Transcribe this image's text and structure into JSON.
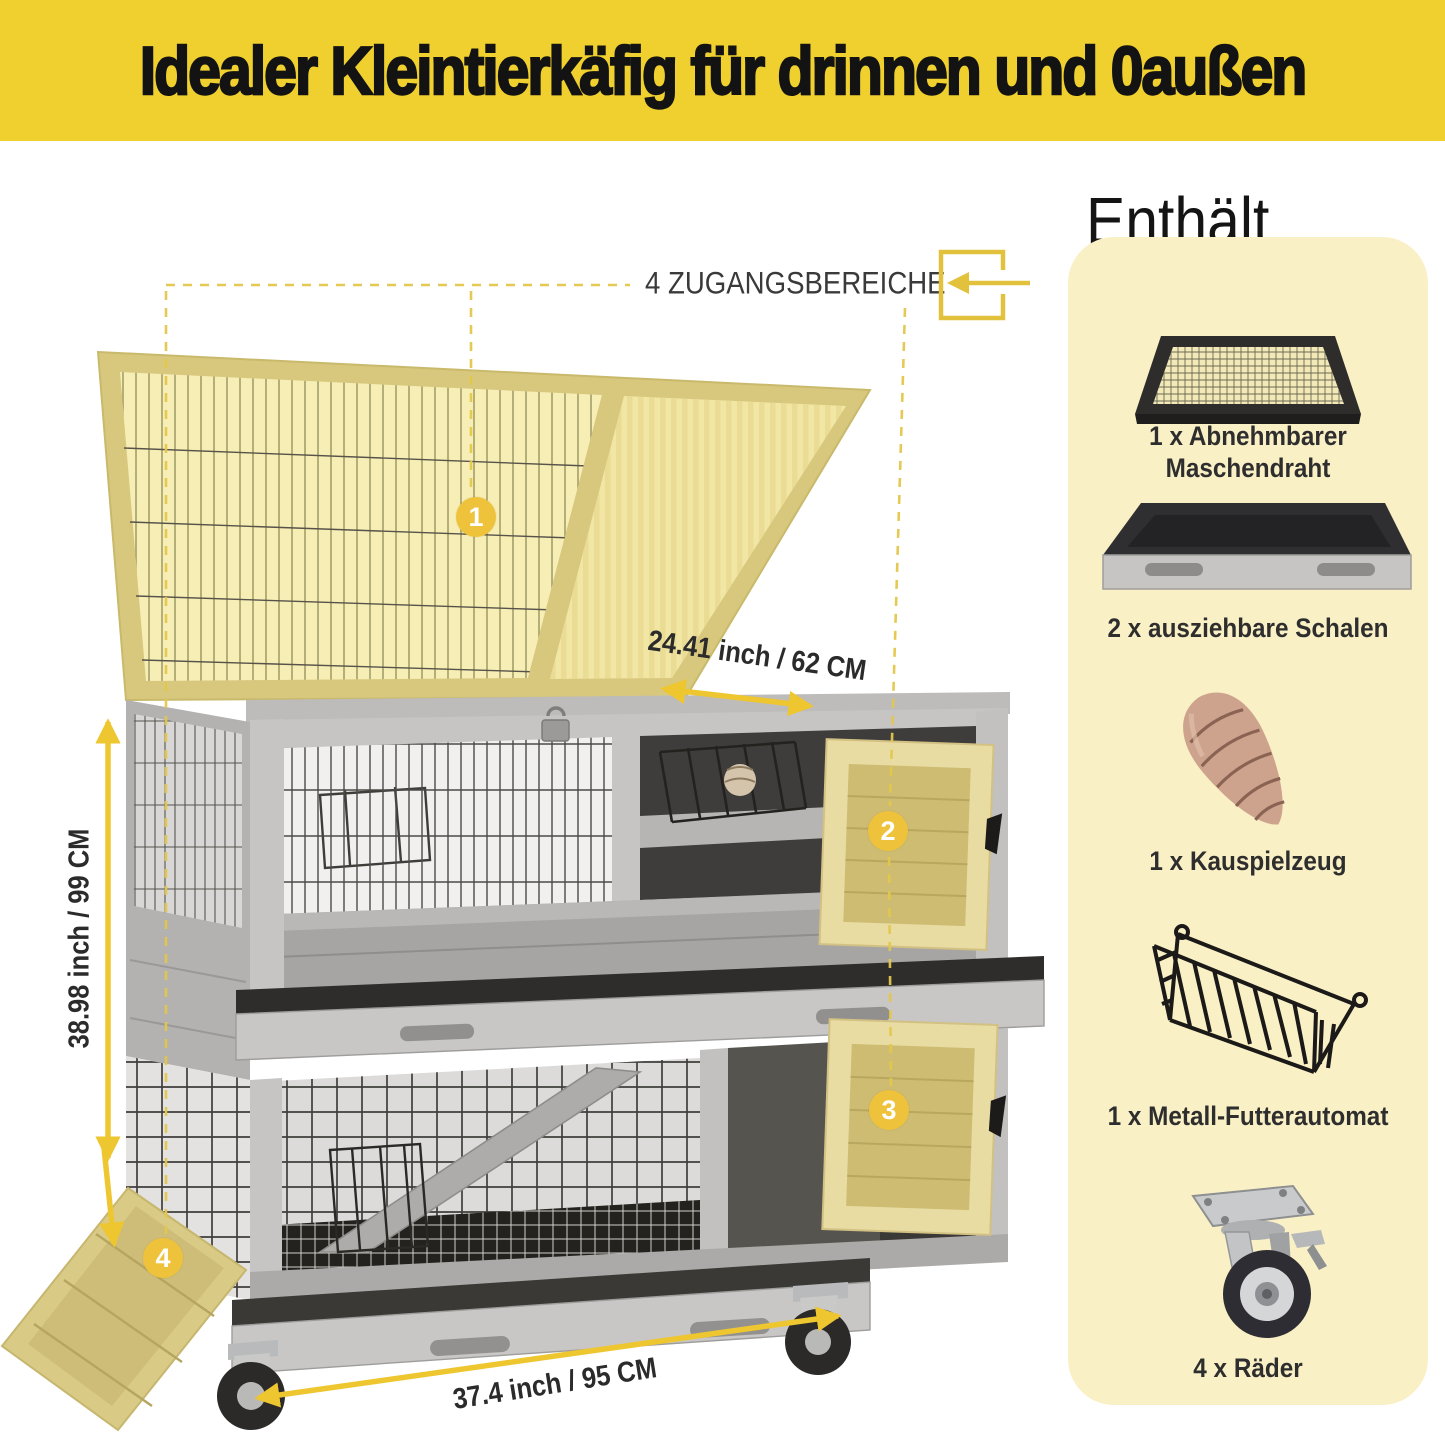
{
  "banner": {
    "title": "Idealer Kleintierkäfig für drinnen und 0außen"
  },
  "annotations": {
    "access_label": "4 ZUGANGSBEREICHE",
    "callouts": [
      "1",
      "2",
      "3",
      "4"
    ],
    "dimensions": {
      "top": "24.41 inch / 62 CM",
      "left": "38.98 inch / 99 CM",
      "bottom": "37.4 inch / 95 CM"
    }
  },
  "includes": {
    "heading": "Enthält",
    "items": [
      {
        "label": "1 x Abnehmbarer Maschendraht",
        "icon": "mesh-panel-icon"
      },
      {
        "label": "2 x ausziehbare Schalen",
        "icon": "slide-out-tray-icon"
      },
      {
        "label": "1 x Kauspielzeug",
        "icon": "chew-toy-icon"
      },
      {
        "label": "1 x Metall-Futterautomat",
        "icon": "metal-feeder-icon"
      },
      {
        "label": "4 x Räder",
        "icon": "caster-wheel-icon"
      }
    ]
  },
  "icons": {
    "access": "enter-arrow-icon"
  },
  "colors": {
    "banner_bg": "#EFD02E",
    "accent": "#EEC62F",
    "accent_dash": "#E3C74B",
    "panel_bg": "#FAF0C5",
    "callout_bg": "#EFC23B",
    "text_dark": "#2B2B2B"
  }
}
